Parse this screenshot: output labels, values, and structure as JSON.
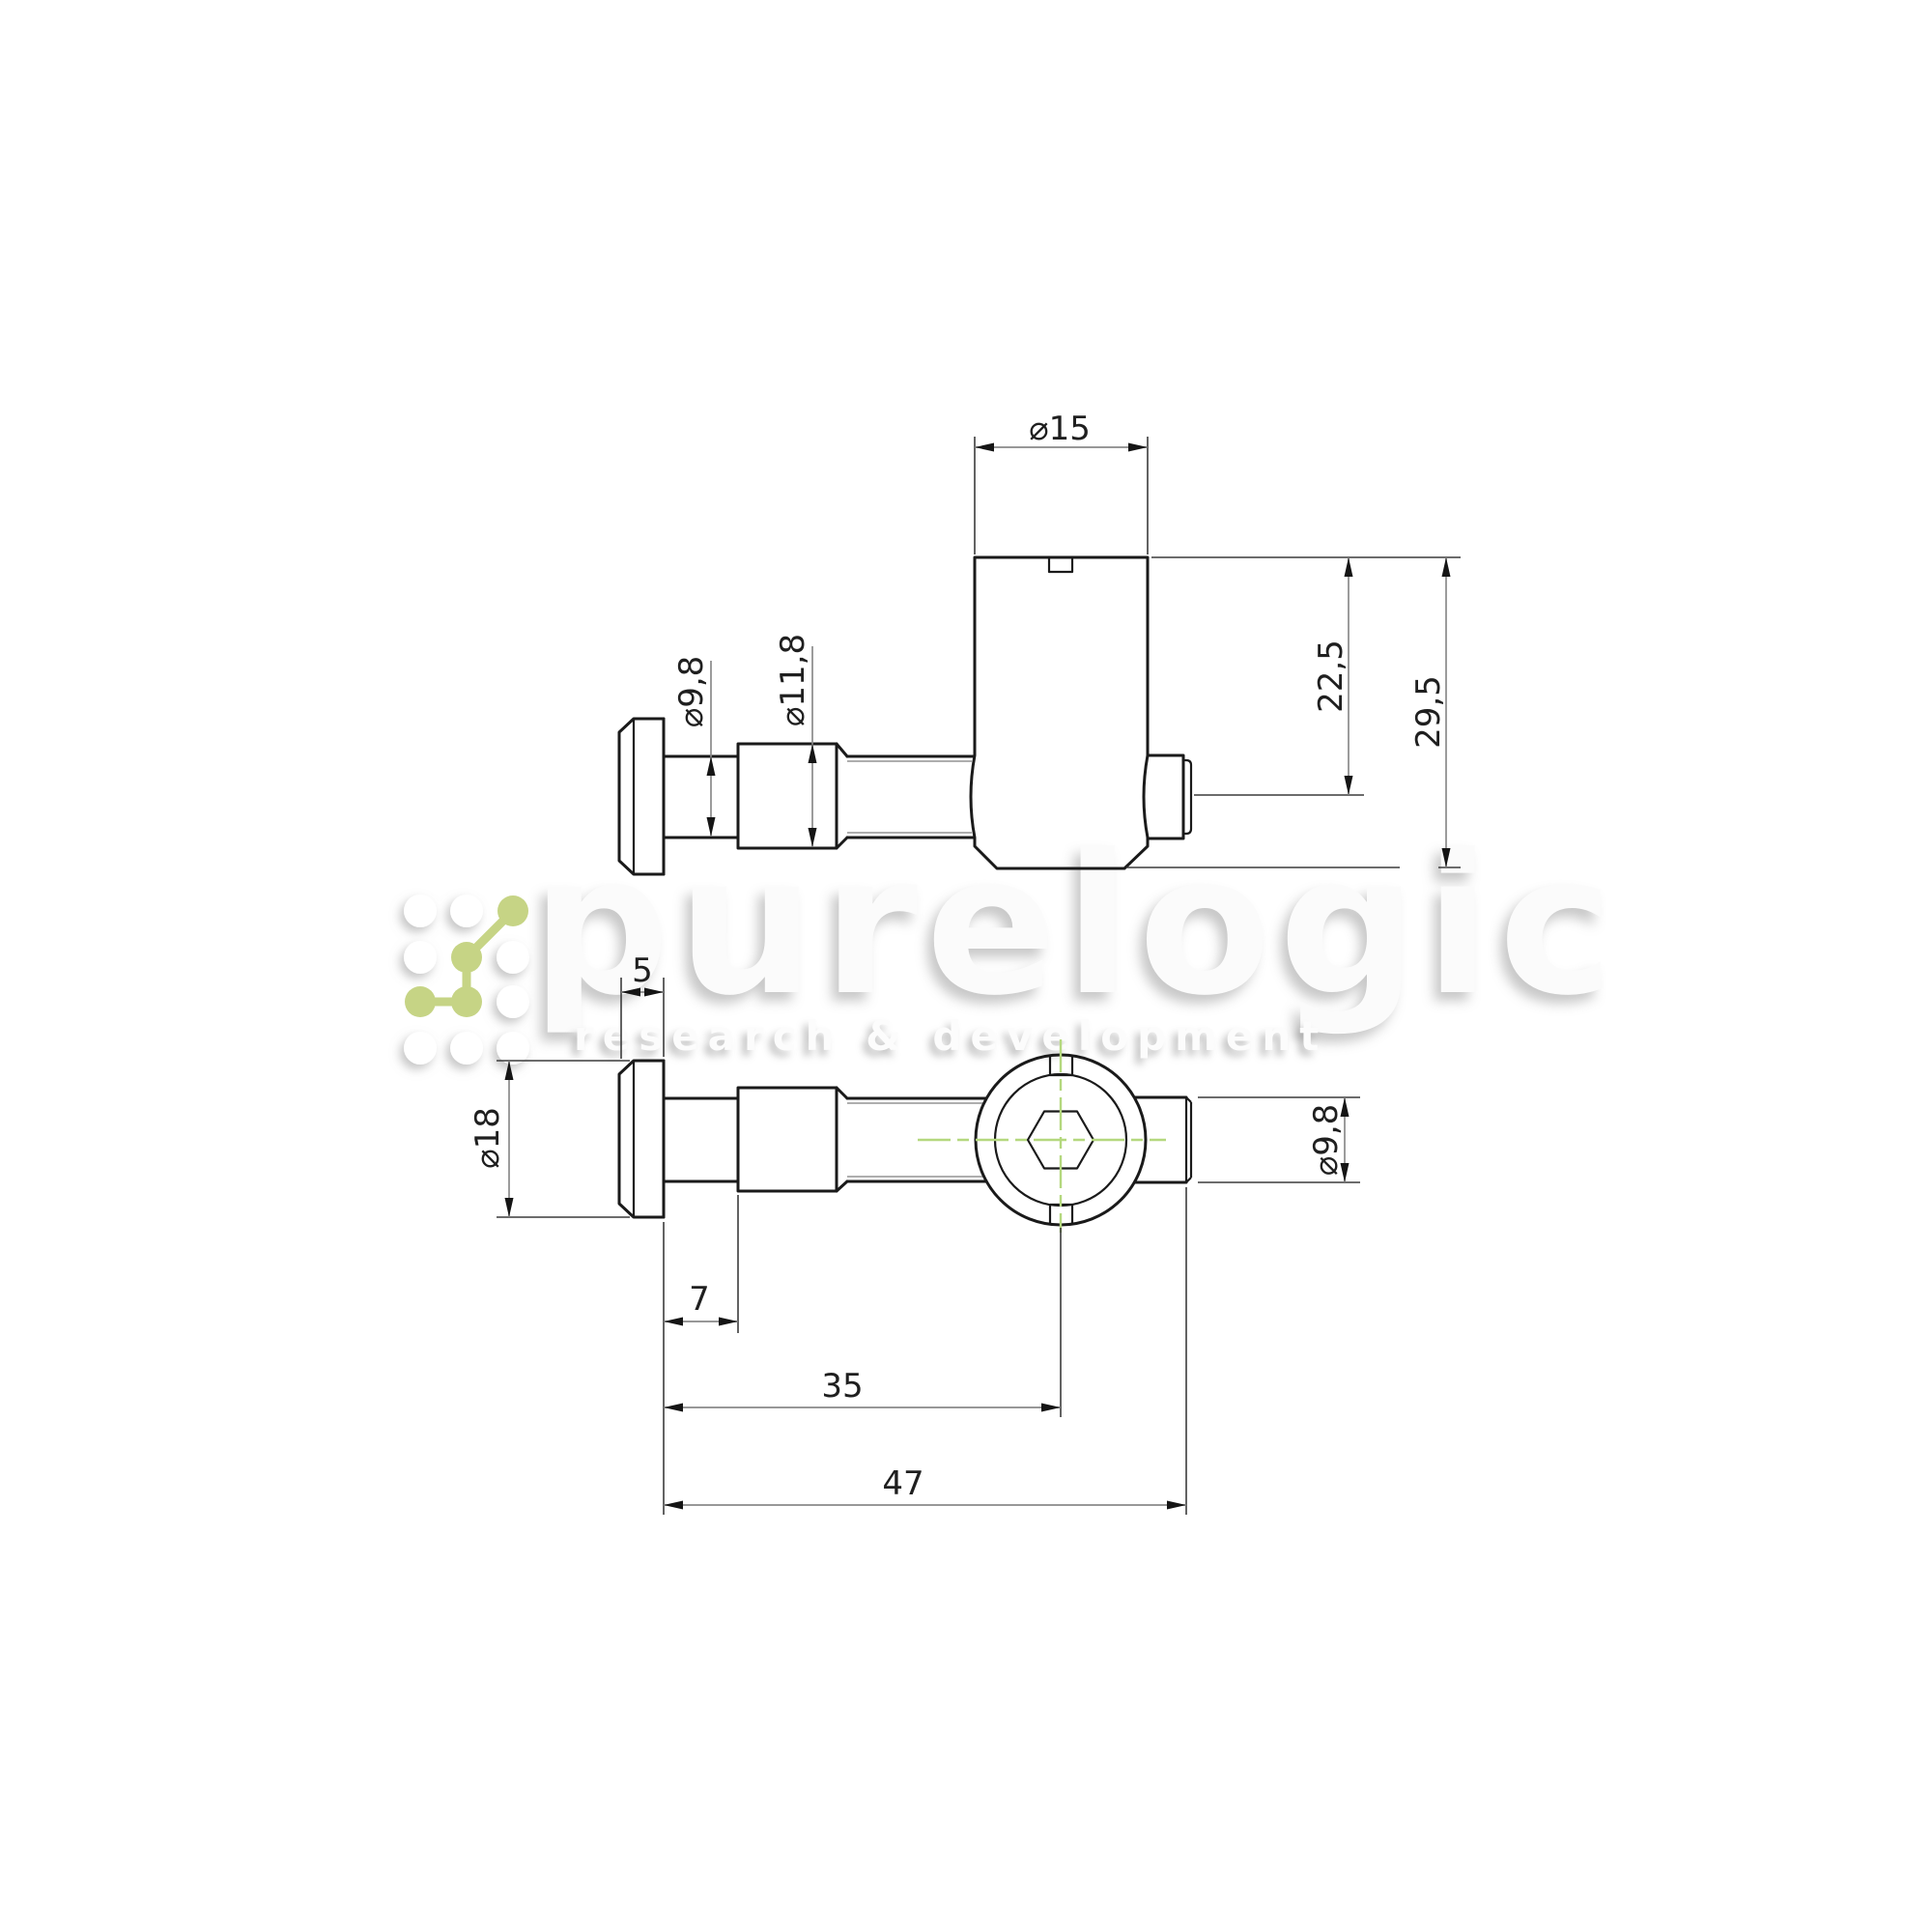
{
  "page": {
    "background": "#ffffff"
  },
  "watermark": {
    "brand": "purelogic",
    "tagline": "research & development",
    "logo_icon": "node-grid-icon",
    "brand_color": "#fbfbfb",
    "tagline_color": "#fcfcfc",
    "logo_green": "#c6d485"
  },
  "colors": {
    "background": "#ffffff",
    "outline": "#1a1a1a",
    "thin_line": "#3c3c3c",
    "dim_line": "#8a8a8a",
    "arrow": "#151515",
    "text": "#1f1f1f",
    "thread_minor": "#949494",
    "centerline_green": "#b4d87e",
    "brand_color": "#fbfbfb",
    "tagline_color": "#fcfcfc",
    "logo_green": "#c6d485"
  },
  "top_view": {
    "dim_diameter_15": "⌀15",
    "dim_diameter_9_8": "⌀9,8",
    "dim_diameter_11_8": "⌀11,8",
    "dim_22_5": "22,5",
    "dim_29_5": "29,5"
  },
  "bottom_view": {
    "dim_5": "5",
    "dim_diameter_18": "⌀18",
    "dim_7": "7",
    "dim_35": "35",
    "dim_47": "47",
    "dim_diameter_9_8": "⌀9,8"
  }
}
